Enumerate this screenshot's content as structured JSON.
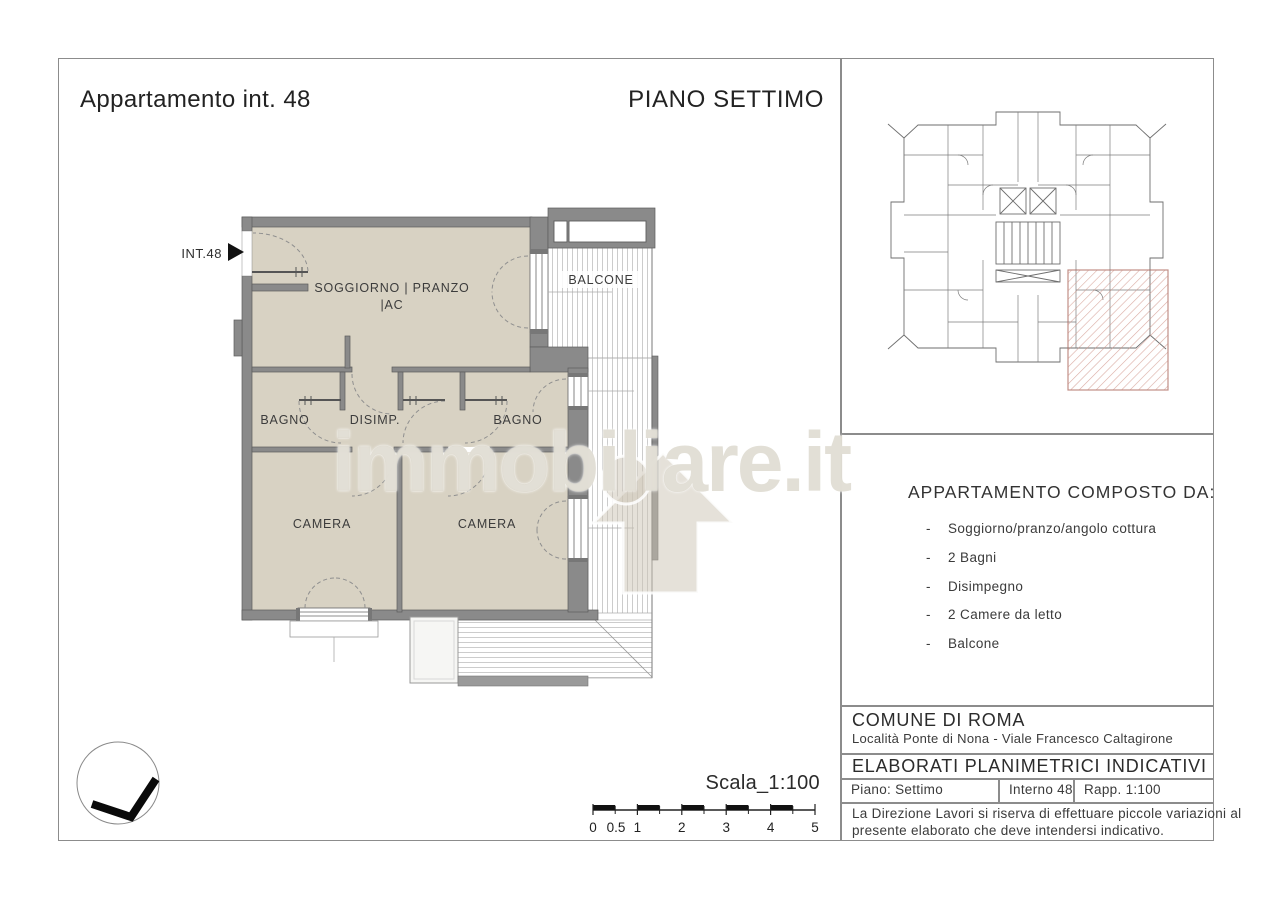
{
  "page": {
    "title_left": "Appartamento int. 48",
    "title_right": "PIANO SETTIMO"
  },
  "floor_plan": {
    "entrance_label": "INT.48",
    "rooms": {
      "soggiorno_line1": "SOGGIORNO | PRANZO",
      "soggiorno_line2": "|AC",
      "balcone": "BALCONE",
      "bagno_left": "BAGNO",
      "disimpegno": "DISIMP.",
      "bagno_right": "BAGNO",
      "camera_left": "CAMERA",
      "camera_right": "CAMERA"
    }
  },
  "watermark": {
    "text": "immobiliare.it"
  },
  "sidebar": {
    "composition": {
      "heading": "APPARTAMENTO COMPOSTO DA:",
      "bullet": "-",
      "items": [
        "Soggiorno/pranzo/angolo cottura",
        "2 Bagni",
        "Disimpegno",
        "2 Camere da letto",
        "Balcone"
      ]
    }
  },
  "title_block": {
    "municipality": "COMUNE DI ROMA",
    "location": "Località Ponte di Nona - Viale Francesco Caltagirone",
    "document_type": "ELABORATI PLANIMETRICI INDICATIVI",
    "floor": "Piano: Settimo",
    "unit": "Interno 48",
    "ratio": "Rapp. 1:100",
    "disclaimer_line1": "La Direzione Lavori si riserva di effettuare piccole variazioni al",
    "disclaimer_line2": "presente elaborato che deve intendersi indicativo."
  },
  "scale_bar": {
    "label": "Scala_1:100",
    "ticks": [
      "0",
      "0.5",
      "1",
      "2",
      "3",
      "4",
      "5"
    ]
  },
  "colors": {
    "wall": "#8a8a8a",
    "room_fill": "#d8d2c3",
    "stripe": "#cccccc",
    "highlight_hatch": "#c4897e",
    "line": "#5c5c5c"
  }
}
